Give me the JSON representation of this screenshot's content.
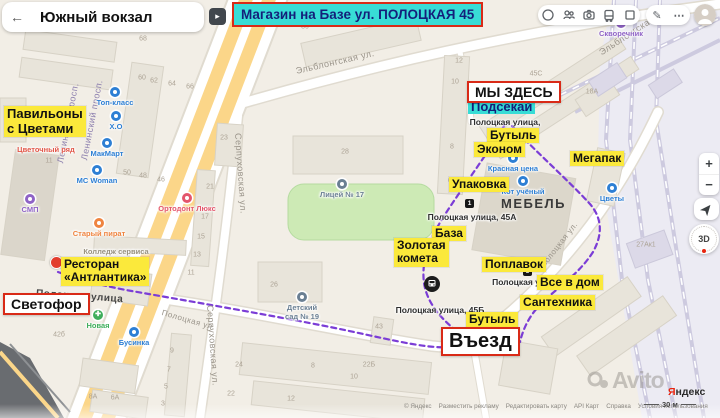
{
  "header": {
    "title": "Южный вокзал",
    "back_icon": "←",
    "expand_icon": "▸",
    "banner": "Магазин на Базе ул. ПОЛОЦКАЯ 45"
  },
  "toolbar": {
    "icon_names": [
      "route-circle-icon",
      "traffic-icon",
      "panorama-camera-icon",
      "transit-bus-icon",
      "layers-icon",
      "edit-pencil-icon",
      "more-ellipsis-icon",
      "user-avatar"
    ],
    "edit_glyph": "✎",
    "more_glyph": "⋯"
  },
  "map_controls": {
    "zoom_in": "+",
    "zoom_out": "−",
    "compass": "3D"
  },
  "map": {
    "district_label": "МЕБЕЛЬ",
    "yellow_labels": [
      {
        "lines": [
          "Павильоны",
          "с Цветами"
        ],
        "x": 4,
        "y": 106,
        "fs": 13
      },
      {
        "lines": [
          "Бутыль"
        ],
        "x": 487,
        "y": 128,
        "fs": 12
      },
      {
        "lines": [
          "Эконом"
        ],
        "x": 474,
        "y": 142,
        "fs": 12
      },
      {
        "lines": [
          "Мегапак"
        ],
        "x": 570,
        "y": 151,
        "fs": 12
      },
      {
        "lines": [
          "Упаковка"
        ],
        "x": 449,
        "y": 177,
        "fs": 12
      },
      {
        "lines": [
          "База"
        ],
        "x": 432,
        "y": 226,
        "fs": 12
      },
      {
        "lines": [
          "Золотая",
          "комета"
        ],
        "x": 394,
        "y": 238,
        "fs": 12
      },
      {
        "lines": [
          "Поплавок"
        ],
        "x": 482,
        "y": 257,
        "fs": 12
      },
      {
        "lines": [
          "Все в дом"
        ],
        "x": 537,
        "y": 275,
        "fs": 12
      },
      {
        "lines": [
          "Сантехника"
        ],
        "x": 520,
        "y": 295,
        "fs": 12
      },
      {
        "lines": [
          "Бутыль"
        ],
        "x": 466,
        "y": 312,
        "fs": 12
      },
      {
        "lines": [
          "Ресторан",
          "«Антлантика»"
        ],
        "x": 61,
        "y": 257,
        "fs": 12
      }
    ],
    "red_labels": [
      {
        "name": "we-are-here-label",
        "text": "МЫ ЗДЕСЬ",
        "x": 467,
        "y": 81,
        "fs": 14
      },
      {
        "name": "svetofor-label",
        "text": "Светофор",
        "x": 3,
        "y": 293,
        "fs": 14
      },
      {
        "name": "entrance-label",
        "text": "Въезд",
        "x": 441,
        "y": 327,
        "fs": 20
      }
    ],
    "cyan_labels": [
      {
        "text": "Подсекай",
        "x": 468,
        "y": 99,
        "fs": 13
      }
    ],
    "street_labels": [
      {
        "text": "Ленинский просп.",
        "x": 60,
        "y": 158,
        "rot": -79,
        "c": "#8c7fae",
        "fs": 9
      },
      {
        "text": "Ленинский просп.",
        "x": 84,
        "y": 155,
        "rot": -79,
        "c": "#8c7fae",
        "fs": 9
      },
      {
        "text": "Серпуховская ул.",
        "x": 238,
        "y": 128,
        "rot": 86,
        "c": "#9a948a",
        "fs": 9
      },
      {
        "text": "Серпуховская ул.",
        "x": 210,
        "y": 300,
        "rot": 86,
        "c": "#9a948a",
        "fs": 9
      },
      {
        "text": "Эльблонгская ул.",
        "x": 296,
        "y": 66,
        "rot": -13,
        "c": "#9a948a",
        "fs": 9
      },
      {
        "text": "Эльблонгская ул.",
        "x": 600,
        "y": 48,
        "rot": -33,
        "c": "#9a948a",
        "fs": 9
      },
      {
        "text": "Полоцкая улица",
        "x": 36,
        "y": 288,
        "rot": 4,
        "c": "#454545",
        "fs": 10,
        "bold": true
      },
      {
        "text": "Полоцкая ул.",
        "x": 162,
        "y": 308,
        "rot": 16,
        "c": "#9a948a",
        "fs": 8
      },
      {
        "text": "Полоцкая ул.",
        "x": 542,
        "y": 262,
        "rot": -52,
        "c": "#9a948a",
        "fs": 8
      }
    ],
    "address_labels": [
      {
        "lines": [
          "Полоцкая улица,",
          "45к2"
        ],
        "x": 505,
        "y": 117
      },
      {
        "lines": [
          "Полоцкая улица, 45А"
        ],
        "x": 472,
        "y": 212
      },
      {
        "lines": [
          "Полоцкая улица, 45Б"
        ],
        "x": 440,
        "y": 305
      },
      {
        "lines": [
          "Полоцкая у"
        ],
        "x": 516,
        "y": 277
      }
    ],
    "pois": [
      {
        "label": "Топ-класс",
        "x": 115,
        "y": 87,
        "c": "#2d7fd4",
        "icon": true
      },
      {
        "label": "Х.О",
        "x": 116,
        "y": 111,
        "c": "#2d7fd4",
        "icon": true
      },
      {
        "label": "МакМарт",
        "x": 107,
        "y": 138,
        "c": "#2d7fd4",
        "icon": true
      },
      {
        "label": "МС Woman",
        "x": 97,
        "y": 165,
        "c": "#2d7fd4",
        "icon": true
      },
      {
        "label": "Красная цена",
        "x": 513,
        "y": 153,
        "c": "#2d7fd4",
        "icon": true
      },
      {
        "label": "Кот учёный",
        "x": 523,
        "y": 176,
        "c": "#2d7fd4",
        "icon": true
      },
      {
        "label": "Цветы",
        "x": 612,
        "y": 183,
        "c": "#2d7fd4",
        "icon": true
      },
      {
        "label": "Бусинка",
        "x": 134,
        "y": 327,
        "c": "#2d7fd4",
        "icon": true
      },
      {
        "label": "СМП",
        "x": 30,
        "y": 194,
        "c": "#8f63c6",
        "icon": true
      },
      {
        "label": "Скворечник",
        "x": 621,
        "y": 18,
        "c": "#8f63c6",
        "icon": true
      },
      {
        "label": "Цветочный ряд",
        "x": 46,
        "y": 146,
        "c": "#e25648",
        "icon": false
      },
      {
        "label": "Старый пират",
        "x": 99,
        "y": 218,
        "c": "#ef8440",
        "icon": true
      },
      {
        "label": "Ортодонт Люкс",
        "x": 187,
        "y": 193,
        "c": "#e4566c",
        "icon": true
      },
      {
        "label": "Новая",
        "x": 98,
        "y": 310,
        "c": "#3fae5c",
        "icon": true,
        "glyph": "✚"
      },
      {
        "label": "Лицей № 17",
        "x": 342,
        "y": 179,
        "c": "#6a7f93",
        "icon": true
      },
      {
        "label": "Детский",
        "label2": "сад № 19",
        "x": 302,
        "y": 292,
        "c": "#6a7f93",
        "icon": true
      },
      {
        "label": "Колледж сервиса",
        "x": 116,
        "y": 248,
        "c": "#98917f",
        "icon": false
      },
      {
        "label": "Baltmotors",
        "x": 150,
        "y": 22,
        "c": "#8b7fc7",
        "icon": false
      }
    ],
    "building_numbers": [
      [
        "68",
        143,
        39
      ],
      [
        "60",
        142,
        78
      ],
      [
        "62",
        154,
        81
      ],
      [
        "64",
        172,
        84
      ],
      [
        "66",
        190,
        87
      ],
      [
        "30",
        305,
        27
      ],
      [
        "12",
        459,
        61
      ],
      [
        "10",
        455,
        82
      ],
      [
        "8",
        452,
        147
      ],
      [
        "6",
        450,
        181
      ],
      [
        "45С",
        536,
        74
      ],
      [
        "18А",
        592,
        92
      ],
      [
        "28",
        345,
        152
      ],
      [
        "23",
        224,
        138
      ],
      [
        "21",
        210,
        187
      ],
      [
        "17",
        205,
        217
      ],
      [
        "15",
        201,
        237
      ],
      [
        "13",
        197,
        255
      ],
      [
        "46",
        161,
        180
      ],
      [
        "50",
        127,
        173
      ],
      [
        "48",
        143,
        176
      ],
      [
        "11",
        49,
        161
      ],
      [
        "26",
        274,
        285
      ],
      [
        "11",
        191,
        273
      ],
      [
        "43",
        379,
        327
      ],
      [
        "22Б",
        369,
        365
      ],
      [
        "24",
        239,
        365
      ],
      [
        "8",
        313,
        366
      ],
      [
        "10",
        354,
        377
      ],
      [
        "22",
        231,
        394
      ],
      [
        "12",
        291,
        399
      ],
      [
        "42б",
        59,
        335
      ],
      [
        "8А",
        93,
        397
      ],
      [
        "6А",
        115,
        398
      ],
      [
        "9",
        172,
        351
      ],
      [
        "7",
        169,
        370
      ],
      [
        "5",
        166,
        387
      ],
      [
        "3",
        163,
        404
      ],
      [
        "27Ак1",
        646,
        245
      ]
    ],
    "transit_stops": [
      {
        "kind": "bus",
        "x": 424,
        "y": 276
      },
      {
        "kind": "sq",
        "n": "1",
        "x": 465,
        "y": 199
      },
      {
        "kind": "sq",
        "n": "3",
        "x": 523,
        "y": 267
      }
    ],
    "route_paths": [
      "M504,126 C490,150 462,188 444,216 C430,238 421,260 424,283 C427,303 441,319 459,333",
      "M512,126 C536,152 568,180 590,204 C602,218 603,234 593,252 C577,277 552,291 538,307 C529,317 523,329 520,342",
      "M58,272 C80,280 100,285 126,290 C200,303 280,317 330,327 C380,337 424,349 448,347 C456,346 461,341 464,336"
    ],
    "start_pin": {
      "x": 50,
      "y": 256
    }
  },
  "colors": {
    "accent-red": "#d92a17",
    "label-yellow": "#fbe93b",
    "label-cyan": "#38dcd6",
    "navy-text": "#141f7a",
    "route-purple": "#7b3dd6",
    "road-yellow": "#fbd689",
    "park-green": "#cdeab5",
    "railway-bg": "#ecebf3",
    "map-bg": "#f2eee6"
  },
  "attribution": {
    "links": [
      "© Яндекс",
      "Разместить рекламу",
      "Редактировать карту",
      "API Карт",
      "Справка",
      "Условия использования"
    ],
    "scale_label": "30 м",
    "logo_first": "Я",
    "logo_rest": "ндекс",
    "watermark": "Avito"
  }
}
